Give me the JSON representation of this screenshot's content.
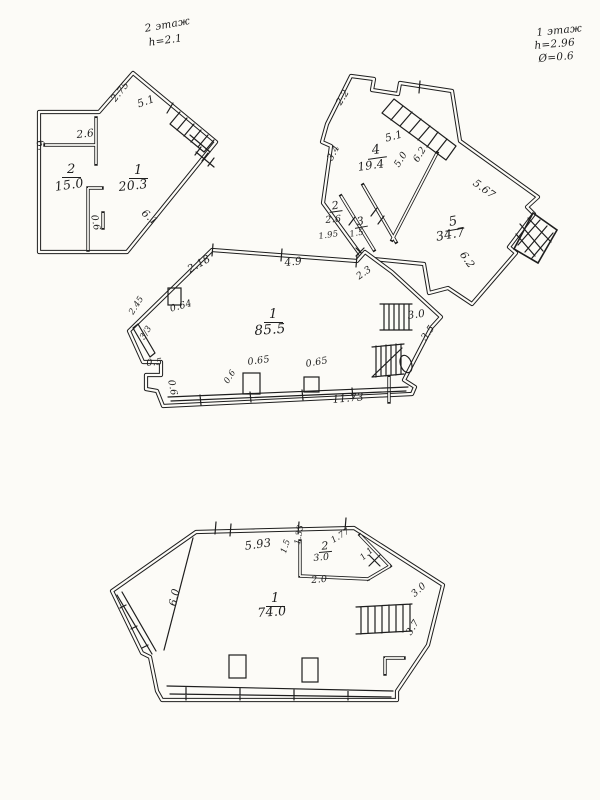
{
  "document": {
    "type": "hand-drawn floor plan sketch, three plans on one scanned sheet",
    "paper_color": "#fcfbf7",
    "ink_color": "#1e1e1e"
  },
  "notes": {
    "top_left": [
      "2 этаж",
      "h=2.1"
    ],
    "top_right": [
      "1 этаж",
      "h=2.96",
      "Ø=0.6"
    ]
  },
  "plans": {
    "upper_left": {
      "rooms": [
        {
          "number": "2",
          "area": "15.0"
        },
        {
          "number": "1",
          "area": "20.3"
        }
      ],
      "dimensions": [
        "2.75",
        "5.1",
        "2.6",
        "6.",
        "6.1",
        "0.6"
      ]
    },
    "upper_right": {
      "rooms": [
        {
          "number": "4",
          "area": "19.4"
        },
        {
          "number": "2",
          "area": "2.6"
        },
        {
          "number": "3",
          "area": "1.5"
        },
        {
          "number": "5",
          "area": "34.7"
        }
      ],
      "dimensions": [
        "2.2",
        "5.1",
        "3.4",
        "5.0",
        "6.2",
        "1.95",
        "5.67",
        "6.2",
        "2.3"
      ]
    },
    "middle": {
      "rooms": [
        {
          "number": "1",
          "area": "85.5"
        }
      ],
      "dimensions": [
        "2.18",
        "4.9",
        "0.64",
        "2.45",
        "3/3",
        "0.5",
        "0.6",
        "0.65",
        "0.6",
        "0.65",
        "11.73",
        "3.0",
        "3.5"
      ]
    },
    "bottom": {
      "rooms": [
        {
          "number": "2",
          "area": "3.0"
        },
        {
          "number": "1",
          "area": "74.0"
        }
      ],
      "dimensions": [
        "5.93",
        "1.5",
        "1.33",
        "1.77",
        "1.1",
        "2.0",
        "6.0",
        "3.0",
        "3.7"
      ]
    }
  },
  "labels": [
    "2 этаж",
    "h=2.1",
    "1 этаж",
    "h=2.96",
    "Ø=0.6",
    "2.75",
    "5.1",
    "2.6",
    "6.",
    "2",
    "15.0",
    "1",
    "20.3",
    "6.1",
    "0.6",
    "2.2",
    "5.1",
    "4",
    "19.4",
    "3.4",
    "5.0",
    "6.2",
    "2",
    "2.6",
    "1.95",
    "3",
    "1.5",
    "5.67",
    "5",
    "34.7",
    "6.2",
    "2.3",
    "2.18",
    "4.9",
    "0.64",
    "2.45",
    "3/3",
    "1",
    "85.5",
    "0.5",
    "0.6",
    "0.65",
    "0.6",
    "0.65",
    "11.73",
    "3.0",
    "3.5",
    "5.93",
    "1.5",
    "1.33",
    "2",
    "3.0",
    "1.77",
    "1.1",
    "2.0",
    "1",
    "74.0",
    "6.0",
    "3.0",
    "3.7"
  ]
}
